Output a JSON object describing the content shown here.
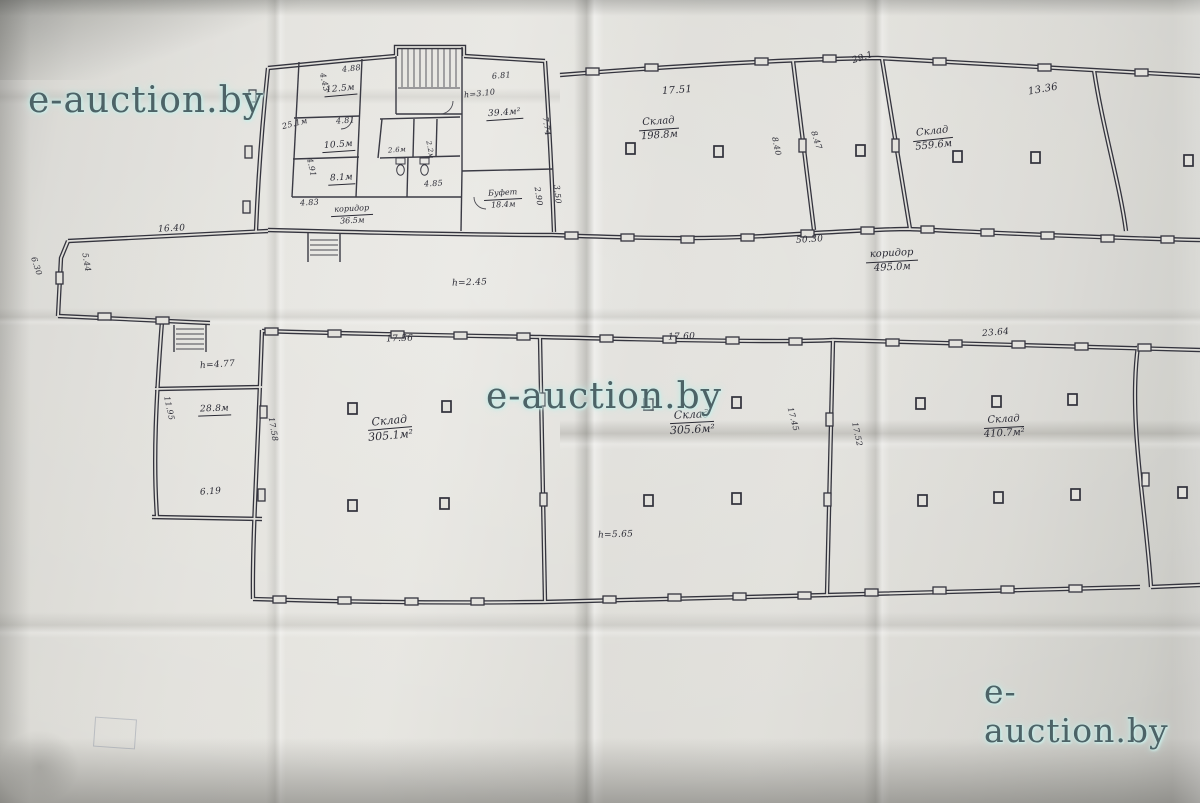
{
  "watermark": {
    "text": "e-auction.by"
  },
  "plan": {
    "upper_band": {
      "warehouse_1": {
        "name": "Склад",
        "area": "198.8м"
      },
      "warehouse_2": {
        "name": "Склад",
        "area": "559.6м"
      },
      "dim_top_1": "17.51",
      "dim_top_2": "13.36",
      "dim_corner": "29.1",
      "dim_rot_1": "8.40",
      "dim_rot_2": "8.47"
    },
    "office": {
      "hall_dim": "25.1м",
      "room_a": {
        "area": "12.5м",
        "dim": "4.88",
        "dim2": "4.43"
      },
      "room_b": {
        "area": "10.5м",
        "dim": "4.81"
      },
      "room_c": {
        "area": "8.1м",
        "dim": "4.91"
      },
      "corridor": {
        "name": "коридор",
        "area": "36.5м",
        "dim": "4.83"
      },
      "wc": {
        "dim1": "2.6м",
        "dim2": "2.2м",
        "dim3": "4.85"
      },
      "big_room": {
        "area": "39.4м²",
        "height": "h=3.10",
        "dim": "6.81",
        "dim2": "7.74"
      },
      "buffet": {
        "name": "Буфет",
        "area": "18.4м",
        "dim": "2.90",
        "dim2": "3.50"
      }
    },
    "corridor": {
      "name": "коридор",
      "area": "495.0м",
      "dim_width": "50.30",
      "dim_west": "16.40",
      "dim_1": "6.30",
      "dim_2": "5.44",
      "height": "h=2.45"
    },
    "lower_band": {
      "anteroom_height": "h=4.77",
      "room_left": {
        "area": "28.8м",
        "dim_w": "6.19",
        "dim_h": "11.95"
      },
      "warehouse_1": {
        "name": "Склад",
        "area": "305.1м²",
        "dim_top": "17.56",
        "dim_side": "17.58"
      },
      "warehouse_2": {
        "name": "Склад",
        "area": "305.6м²",
        "dim_top": "17.60",
        "dim_side": "17.45",
        "height": "h=5.65"
      },
      "warehouse_3": {
        "name": "Склад",
        "area": "410.7м²",
        "dim_top": "23.64",
        "dim_side": "17.52"
      }
    }
  }
}
